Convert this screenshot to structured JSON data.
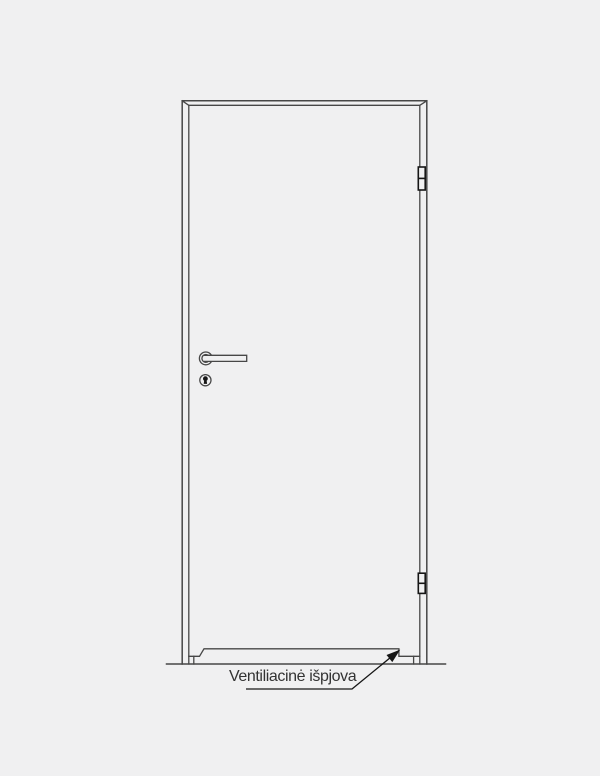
{
  "label": {
    "text": "Ventiliacinė išpjova"
  },
  "colors": {
    "background": "#f0f0f1",
    "line": "#474747",
    "dark_line": "#161616",
    "text": "#333333"
  }
}
